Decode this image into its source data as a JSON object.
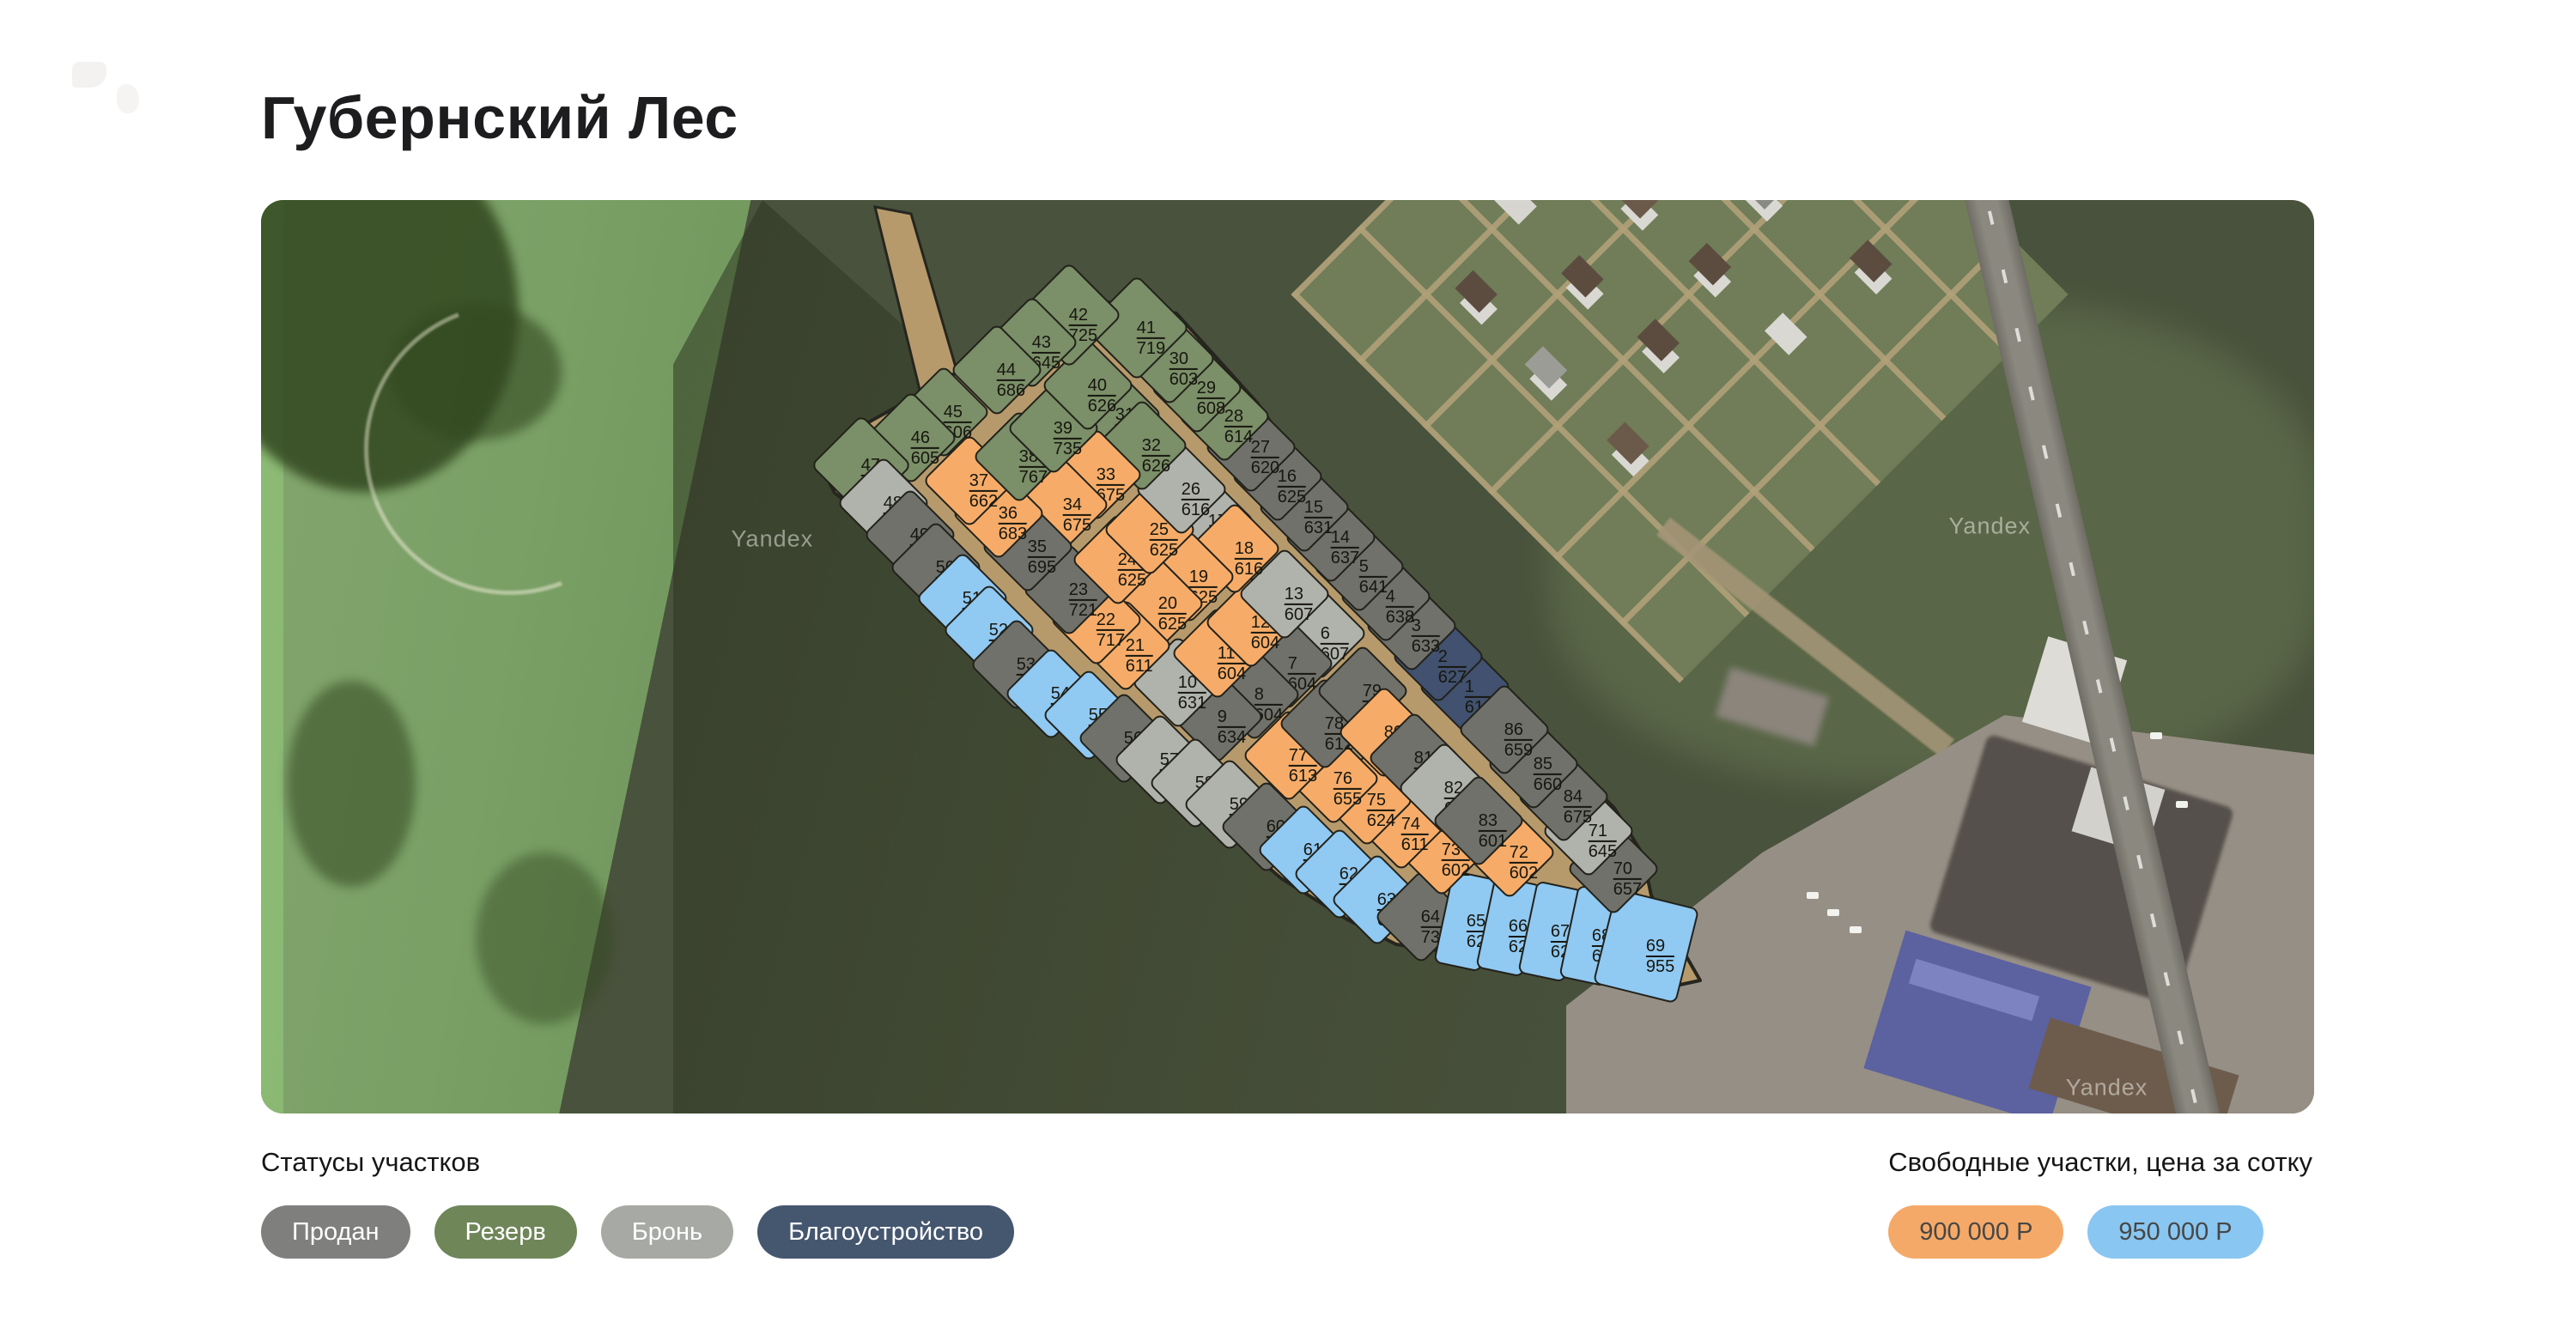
{
  "page": {
    "title": "Губернский Лес"
  },
  "map": {
    "watermark_text": "Yandex",
    "watermarks": [
      {
        "x": 24.9,
        "y": 37.1
      },
      {
        "x": 84.2,
        "y": 35.7
      },
      {
        "x": 89.9,
        "y": 97.2
      }
    ],
    "status_colors": {
      "sold": "#70716b",
      "reserve": "#7b8f68",
      "booked": "#b0b2ac",
      "landscaping": "#41516f",
      "free900": "#f6ac68",
      "free950": "#90c9f2"
    },
    "plots": [
      {
        "n": 1,
        "v": 618,
        "s": "landscaping",
        "x": 58.64,
        "y": 53.29
      },
      {
        "n": 2,
        "v": 627,
        "s": "landscaping",
        "x": 57.34,
        "y": 50.0
      },
      {
        "n": 3,
        "v": 633,
        "s": "sold",
        "x": 56.04,
        "y": 46.62
      },
      {
        "n": 4,
        "v": 638,
        "s": "sold",
        "x": 54.79,
        "y": 43.42
      },
      {
        "n": 5,
        "v": 641,
        "s": "sold",
        "x": 53.49,
        "y": 40.13
      },
      {
        "n": 6,
        "v": 607,
        "s": "booked",
        "x": 51.61,
        "y": 47.46
      },
      {
        "n": 7,
        "v": 604,
        "s": "sold",
        "x": 50.02,
        "y": 50.75
      },
      {
        "n": 8,
        "v": 604,
        "s": "sold",
        "x": 48.39,
        "y": 54.14
      },
      {
        "n": 9,
        "v": 634,
        "s": "sold",
        "x": 46.59,
        "y": 56.58
      },
      {
        "n": 10,
        "v": 631,
        "s": "booked",
        "x": 44.67,
        "y": 52.82
      },
      {
        "n": 11,
        "v": 604,
        "s": "free900",
        "x": 46.59,
        "y": 49.62
      },
      {
        "n": 12,
        "v": 604,
        "s": "free900",
        "x": 48.22,
        "y": 46.24
      },
      {
        "n": 13,
        "v": 607,
        "s": "booked",
        "x": 49.85,
        "y": 43.14
      },
      {
        "n": 14,
        "v": 637,
        "s": "sold",
        "x": 52.11,
        "y": 36.94
      },
      {
        "n": 15,
        "v": 631,
        "s": "sold",
        "x": 50.82,
        "y": 33.65
      },
      {
        "n": 16,
        "v": 625,
        "s": "sold",
        "x": 49.52,
        "y": 30.26
      },
      {
        "n": 17,
        "v": 620,
        "s": "booked",
        "x": 46.13,
        "y": 35.15
      },
      {
        "n": 18,
        "v": 616,
        "s": "free900",
        "x": 47.43,
        "y": 38.16
      },
      {
        "n": 19,
        "v": 625,
        "s": "free900",
        "x": 45.21,
        "y": 41.26
      },
      {
        "n": 20,
        "v": 625,
        "s": "free900",
        "x": 43.71,
        "y": 44.17
      },
      {
        "n": 21,
        "v": 611,
        "s": "free900",
        "x": 42.12,
        "y": 48.78
      },
      {
        "n": 22,
        "v": 717,
        "s": "free900",
        "x": 40.69,
        "y": 45.96
      },
      {
        "n": 23,
        "v": 721,
        "s": "sold",
        "x": 39.36,
        "y": 42.67
      },
      {
        "n": 24,
        "v": 625,
        "s": "free900",
        "x": 41.74,
        "y": 39.38
      },
      {
        "n": 25,
        "v": 625,
        "s": "free900",
        "x": 43.29,
        "y": 36.09
      },
      {
        "n": 26,
        "v": 616,
        "s": "booked",
        "x": 44.84,
        "y": 31.67
      },
      {
        "n": 27,
        "v": 620,
        "s": "sold",
        "x": 48.22,
        "y": 27.07
      },
      {
        "n": 28,
        "v": 614,
        "s": "reserve",
        "x": 46.93,
        "y": 23.68
      },
      {
        "n": 29,
        "v": 608,
        "s": "reserve",
        "x": 45.59,
        "y": 20.58
      },
      {
        "n": 30,
        "v": 603,
        "s": "reserve",
        "x": 44.25,
        "y": 17.39
      },
      {
        "n": 31,
        "v": 630,
        "s": "reserve",
        "x": 41.61,
        "y": 23.5
      },
      {
        "n": 32,
        "v": 626,
        "s": "reserve",
        "x": 42.91,
        "y": 26.88
      },
      {
        "n": 33,
        "v": 675,
        "s": "free900",
        "x": 40.69,
        "y": 30.08
      },
      {
        "n": 34,
        "v": 675,
        "s": "free900",
        "x": 39.06,
        "y": 33.36
      },
      {
        "n": 35,
        "v": 695,
        "s": "sold",
        "x": 37.35,
        "y": 37.97
      },
      {
        "n": 36,
        "v": 683,
        "s": "free900",
        "x": 35.93,
        "y": 34.3
      },
      {
        "n": 37,
        "v": 662,
        "s": "free900",
        "x": 34.5,
        "y": 30.73
      },
      {
        "n": 38,
        "v": 767,
        "s": "reserve",
        "x": 36.93,
        "y": 28.1
      },
      {
        "n": 39,
        "v": 735,
        "s": "reserve",
        "x": 38.6,
        "y": 25.0
      },
      {
        "n": 40,
        "v": 626,
        "s": "reserve",
        "x": 40.28,
        "y": 20.3
      },
      {
        "n": 41,
        "v": 719,
        "s": "reserve",
        "x": 42.66,
        "y": 14.0,
        "w": 84,
        "h": 84
      },
      {
        "n": 42,
        "v": 725,
        "s": "reserve",
        "x": 39.36,
        "y": 12.59,
        "w": 84,
        "h": 84
      },
      {
        "n": 43,
        "v": 645,
        "s": "reserve",
        "x": 37.56,
        "y": 15.6
      },
      {
        "n": 44,
        "v": 686,
        "s": "reserve",
        "x": 35.84,
        "y": 18.61
      },
      {
        "n": 45,
        "v": 606,
        "s": "reserve",
        "x": 33.25,
        "y": 23.21
      },
      {
        "n": 46,
        "v": 605,
        "s": "reserve",
        "x": 31.66,
        "y": 26.03
      },
      {
        "n": 47,
        "v": 760,
        "s": "reserve",
        "x": 29.23,
        "y": 29.04,
        "w": 80,
        "h": 80
      },
      {
        "n": 48,
        "v": 622,
        "s": "booked",
        "x": 30.32,
        "y": 33.18
      },
      {
        "n": 49,
        "v": 622,
        "s": "sold",
        "x": 31.62,
        "y": 36.65
      },
      {
        "n": 50,
        "v": 622,
        "s": "sold",
        "x": 32.87,
        "y": 40.23
      },
      {
        "n": 51,
        "v": 623,
        "s": "free950",
        "x": 34.17,
        "y": 43.61
      },
      {
        "n": 52,
        "v": 623,
        "s": "free950",
        "x": 35.47,
        "y": 47.09
      },
      {
        "n": 53,
        "v": 673,
        "s": "sold",
        "x": 36.8,
        "y": 50.85
      },
      {
        "n": 54,
        "v": 666,
        "s": "free950",
        "x": 38.48,
        "y": 54.04
      },
      {
        "n": 55,
        "v": 623,
        "s": "free950",
        "x": 40.32,
        "y": 56.39
      },
      {
        "n": 56,
        "v": 619,
        "s": "sold",
        "x": 42.03,
        "y": 58.93
      },
      {
        "n": 57,
        "v": 616,
        "s": "booked",
        "x": 43.79,
        "y": 61.28
      },
      {
        "n": 58,
        "v": 612,
        "s": "booked",
        "x": 45.5,
        "y": 63.82
      },
      {
        "n": 59,
        "v": 608,
        "s": "booked",
        "x": 47.17,
        "y": 66.17
      },
      {
        "n": 60,
        "v": 632,
        "s": "sold",
        "x": 48.97,
        "y": 68.61
      },
      {
        "n": 61,
        "v": 638,
        "s": "free950",
        "x": 50.77,
        "y": 71.15
      },
      {
        "n": 62,
        "v": 644,
        "s": "free950",
        "x": 52.53,
        "y": 73.78
      },
      {
        "n": 63,
        "v": 699,
        "s": "free950",
        "x": 54.37,
        "y": 76.6
      },
      {
        "n": 64,
        "v": 736,
        "s": "sold",
        "x": 56.5,
        "y": 78.48
      },
      {
        "n": 65,
        "v": 629,
        "s": "free950",
        "x": 58.72,
        "y": 78.96,
        "w": 52,
        "h": 106,
        "r": 12
      },
      {
        "n": 66,
        "v": 629,
        "s": "free950",
        "x": 60.77,
        "y": 79.52,
        "w": 52,
        "h": 106,
        "r": 12
      },
      {
        "n": 67,
        "v": 629,
        "s": "free950",
        "x": 62.82,
        "y": 80.09,
        "w": 52,
        "h": 106,
        "r": 12
      },
      {
        "n": 68,
        "v": 629,
        "s": "free950",
        "x": 64.83,
        "y": 80.56,
        "w": 52,
        "h": 106,
        "r": 12
      },
      {
        "n": 69,
        "v": 955,
        "s": "free950",
        "x": 67.46,
        "y": 81.67,
        "w": 96,
        "h": 110,
        "r": 14
      },
      {
        "n": 70,
        "v": 657,
        "s": "sold",
        "x": 65.87,
        "y": 73.21
      },
      {
        "n": 71,
        "v": 645,
        "s": "booked",
        "x": 64.66,
        "y": 69.08
      },
      {
        "n": 72,
        "v": 602,
        "s": "free900",
        "x": 60.81,
        "y": 71.43
      },
      {
        "n": 73,
        "v": 602,
        "s": "free900",
        "x": 57.51,
        "y": 71.15
      },
      {
        "n": 74,
        "v": 611,
        "s": "free900",
        "x": 55.54,
        "y": 68.33
      },
      {
        "n": 75,
        "v": 624,
        "s": "free900",
        "x": 53.87,
        "y": 65.7
      },
      {
        "n": 76,
        "v": 655,
        "s": "free900",
        "x": 52.24,
        "y": 63.35
      },
      {
        "n": 77,
        "v": 613,
        "s": "free900",
        "x": 50.06,
        "y": 60.81
      },
      {
        "n": 78,
        "v": 612,
        "s": "sold",
        "x": 51.82,
        "y": 57.33
      },
      {
        "n": 79,
        "v": 609,
        "s": "sold",
        "x": 53.66,
        "y": 53.76
      },
      {
        "n": 80,
        "v": 700,
        "s": "free900",
        "x": 54.7,
        "y": 58.27
      },
      {
        "n": 81,
        "v": 620,
        "s": "sold",
        "x": 56.17,
        "y": 61.09
      },
      {
        "n": 82,
        "v": 602,
        "s": "booked",
        "x": 57.63,
        "y": 64.38
      },
      {
        "n": 83,
        "v": 601,
        "s": "sold",
        "x": 59.31,
        "y": 67.95
      },
      {
        "n": 84,
        "v": 675,
        "s": "sold",
        "x": 63.45,
        "y": 65.32
      },
      {
        "n": 85,
        "v": 660,
        "s": "sold",
        "x": 61.98,
        "y": 61.75
      },
      {
        "n": 86,
        "v": 659,
        "s": "sold",
        "x": 60.56,
        "y": 57.99
      }
    ]
  },
  "legend": {
    "statuses_title": "Статусы участков",
    "statuses": [
      {
        "label": "Продан",
        "color": "#7f807e"
      },
      {
        "label": "Резерв",
        "color": "#6f8659"
      },
      {
        "label": "Бронь",
        "color": "#a7a9a4"
      },
      {
        "label": "Благоустройство",
        "color": "#45566f"
      }
    ],
    "prices_title": "Свободные участки, цена за сотку",
    "prices": [
      {
        "label": "900 000 Р",
        "color": "#f5a968"
      },
      {
        "label": "950 000 Р",
        "color": "#89c6f1"
      }
    ]
  }
}
